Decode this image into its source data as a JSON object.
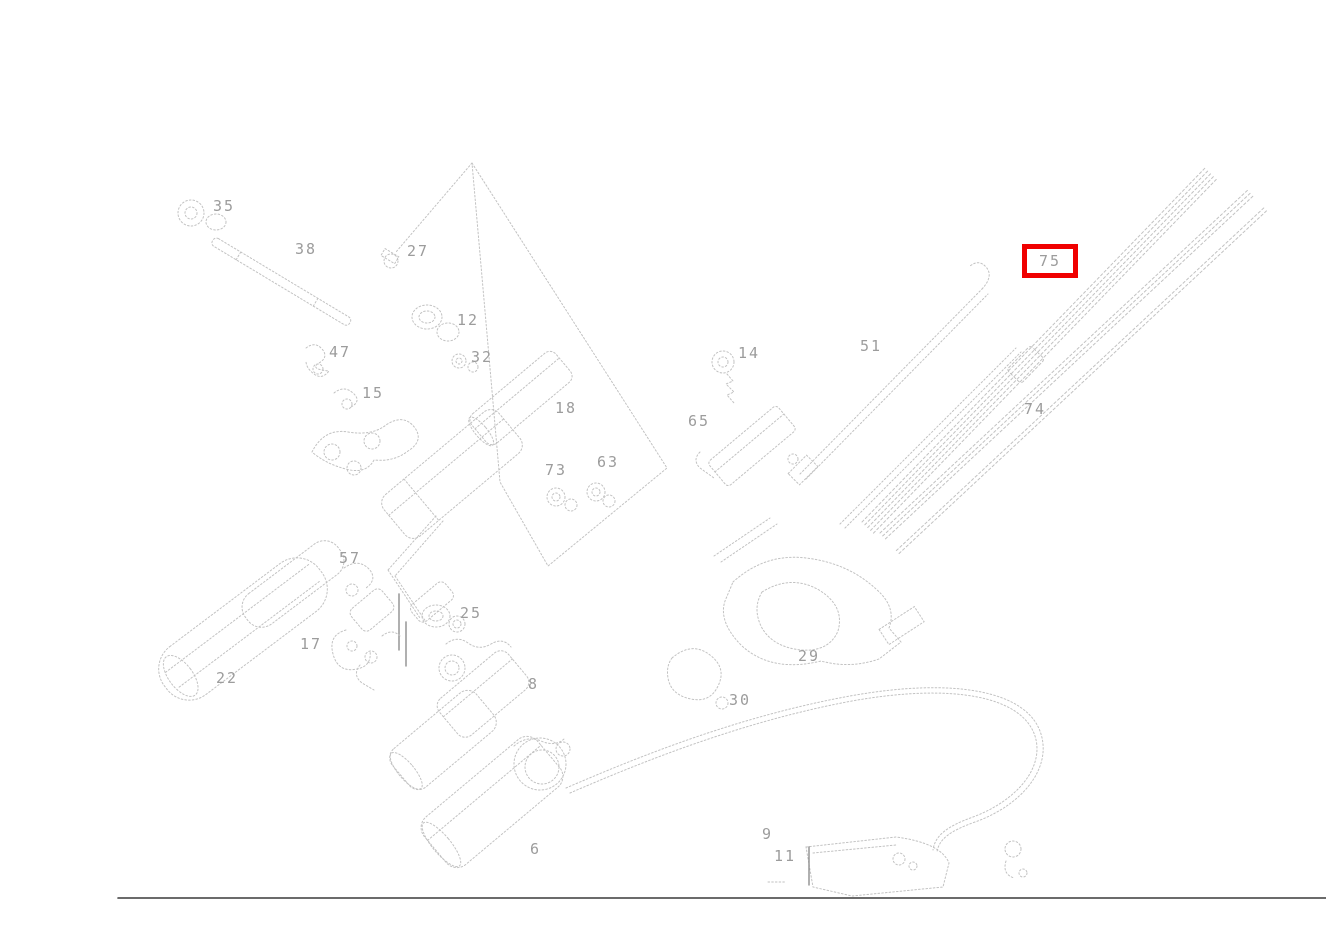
{
  "app": {
    "type": "exploded-parts-diagram",
    "background": "#ffffff"
  },
  "diagram": {
    "line_color": "#c2c2c2",
    "label_color": "#9c9c9c",
    "highlight": {
      "part": "75",
      "box_color": "#f00000",
      "x": 1022,
      "y": 244,
      "width": 56,
      "height": 34
    },
    "parts": [
      {
        "label": "35",
        "x": 213,
        "y": 199
      },
      {
        "label": "38",
        "x": 295,
        "y": 242
      },
      {
        "label": "27",
        "x": 407,
        "y": 244
      },
      {
        "label": "12",
        "x": 457,
        "y": 313
      },
      {
        "label": "47",
        "x": 329,
        "y": 345
      },
      {
        "label": "32",
        "x": 471,
        "y": 350
      },
      {
        "label": "15",
        "x": 362,
        "y": 386
      },
      {
        "label": "18",
        "x": 555,
        "y": 401
      },
      {
        "label": "14",
        "x": 738,
        "y": 346
      },
      {
        "label": "65",
        "x": 688,
        "y": 414
      },
      {
        "label": "51",
        "x": 860,
        "y": 339
      },
      {
        "label": "75",
        "x": 1029,
        "y": 250,
        "highlighted": true
      },
      {
        "label": "74",
        "x": 1024,
        "y": 402
      },
      {
        "label": "73",
        "x": 545,
        "y": 463
      },
      {
        "label": "63",
        "x": 597,
        "y": 455
      },
      {
        "label": "57",
        "x": 339,
        "y": 551
      },
      {
        "label": "17",
        "x": 300,
        "y": 637
      },
      {
        "label": "22",
        "x": 216,
        "y": 671
      },
      {
        "label": "25",
        "x": 460,
        "y": 606
      },
      {
        "label": "8",
        "x": 528,
        "y": 677
      },
      {
        "label": "30",
        "x": 729,
        "y": 693
      },
      {
        "label": "29",
        "x": 798,
        "y": 649
      },
      {
        "label": "6",
        "x": 530,
        "y": 842
      },
      {
        "label": "9",
        "x": 762,
        "y": 827
      },
      {
        "label": "11",
        "x": 774,
        "y": 849
      }
    ]
  }
}
